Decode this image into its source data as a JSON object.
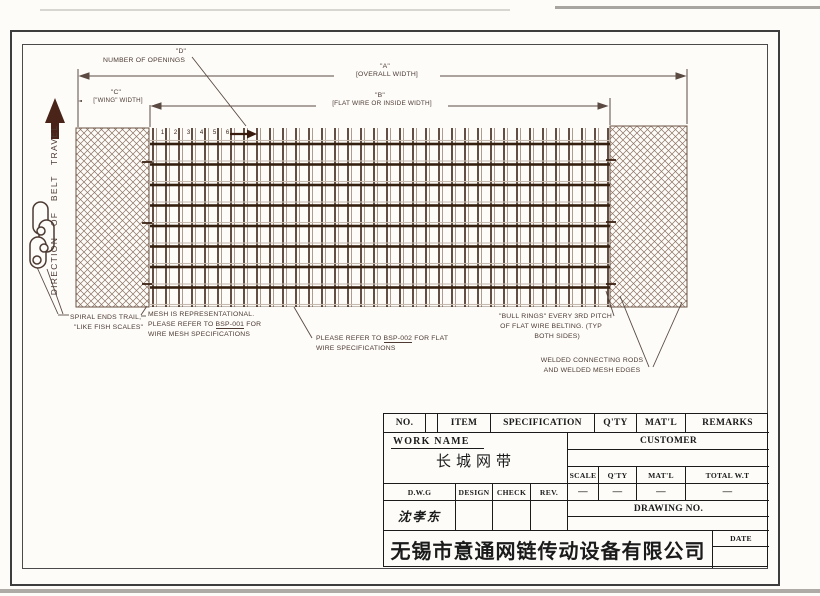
{
  "colors": {
    "ink": "#3a2113",
    "annotation": "#4d3a32",
    "table_ink": "#1b1b1b",
    "dim_line": "#5a4a42",
    "hatch": "#8d7262",
    "mesh_light": "#c7bbb0",
    "arrow": "#4a2418"
  },
  "drawing": {
    "dims": {
      "a_label": "\"A\"",
      "a_text": "[OVERALL WIDTH]",
      "b_label": "\"B\"",
      "b_text": "[FLAT WIRE OR INSIDE WIDTH]",
      "c_label": "\"C\"",
      "c_text": "[\"WING\" WIDTH]",
      "d_label": "\"D\"",
      "d_text": "NUMBER OF OPENINGS"
    },
    "direction_label": "DIRECTION OF BELT TRAVEL",
    "opening_numbers": [
      "1",
      "2",
      "3",
      "4",
      "5",
      "6"
    ],
    "notes": {
      "spiral_l1": "SPIRAL ENDS TRAIL,",
      "spiral_l2": "\"LIKE FISH SCALES\"",
      "mesh_l1": "MESH IS REPRESENTATIONAL.",
      "mesh_l2_pre": "PLEASE REFER TO ",
      "mesh_ref": "BSP-001",
      "mesh_l2_post": " FOR",
      "mesh_l3": "WIRE MESH SPECIFICATIONS",
      "flat_l1_pre": "PLEASE REFER TO ",
      "flat_ref": "BSP-002",
      "flat_l1_post": " FOR FLAT",
      "flat_l2": "WIRE SPECIFICATIONS",
      "bull_l1": "\"BULL RINGS\" EVERY 3RD PITCH",
      "bull_l2": "OF FLAT WIRE BELTING. (TYP",
      "bull_l3": "BOTH SIDES)",
      "welded_l1": "WELDED CONNECTING RODS",
      "welded_l2": "AND WELDED MESH EDGES"
    }
  },
  "title_block": {
    "header": {
      "no": "NO.",
      "item": "ITEM",
      "specification": "SPECIFICATION",
      "qty": "Q'TY",
      "matl": "MAT'L",
      "remarks": "REMARKS"
    },
    "work_name_label": "WORK NAME",
    "work_name_value": "长城网带",
    "customer_label": "CUSTOMER",
    "scale_label": "SCALE",
    "qty_label": "Q'TY",
    "matl_label": "MAT'L",
    "total_wt_label": "TOTAL W.T",
    "scale_value": "—",
    "qty_value": "—",
    "matl_value": "—",
    "total_wt_value": "—",
    "dwg_label": "D.W.G",
    "design_label": "DESIGN",
    "check_label": "CHECK",
    "rev_label": "REV.",
    "dwg_name": "沈孝东",
    "drawing_no_label": "DRAWING NO.",
    "date_label": "DATE",
    "company_name": "无锡市意通网链传动设备有限公司"
  }
}
